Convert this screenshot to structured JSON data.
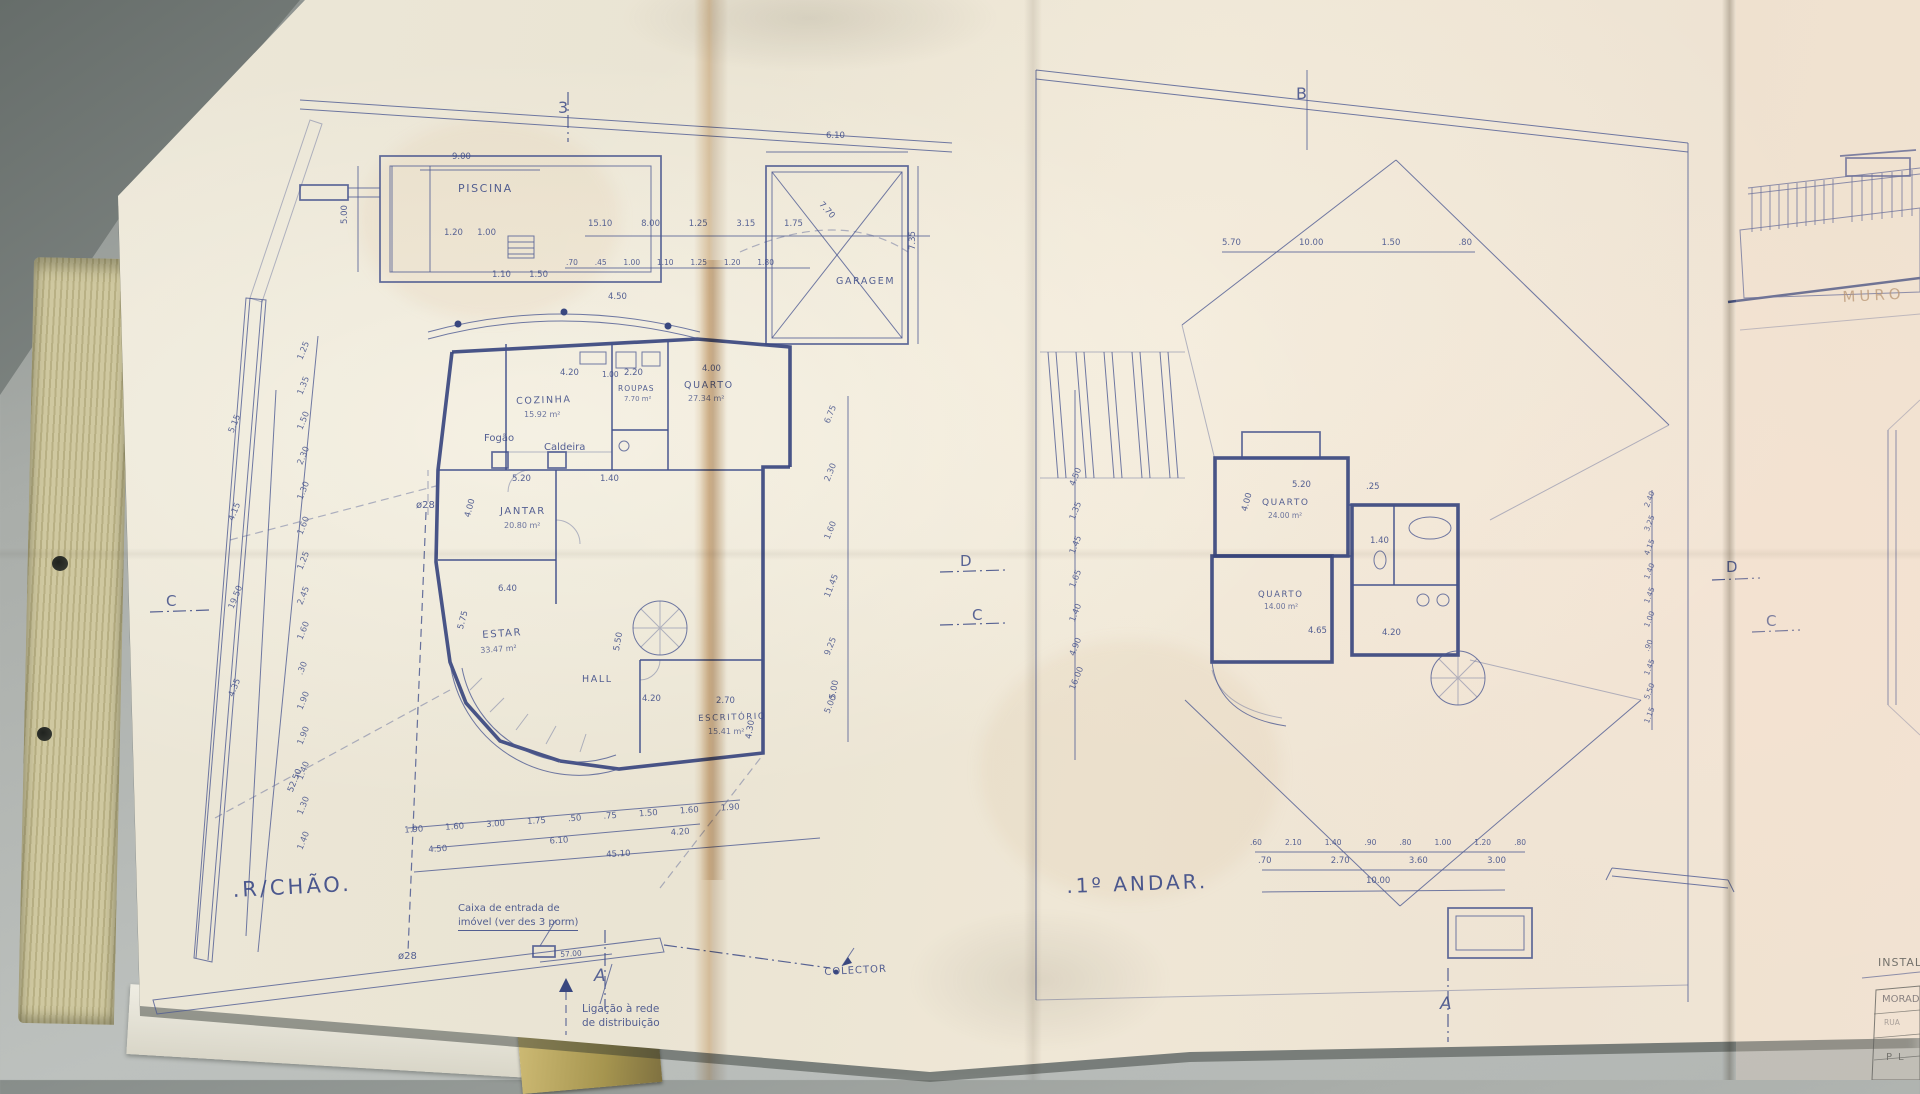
{
  "colors": {
    "ink": "#44538b",
    "ink_dark": "#39477f",
    "paper": "#ece6d6",
    "crease_tan": "#c89a5e",
    "desk": "#a9ada9",
    "binder_edge": "#c8c197",
    "muro_faded": "#a8835f"
  },
  "left_plan": {
    "title": ".R/CHÃO.",
    "markers": {
      "top": "3",
      "left": "C",
      "mid_d": "D",
      "mid_c": "C",
      "bottom": "A"
    },
    "pool": {
      "label": "PISCINA",
      "dim_w": "9.00",
      "dim_h": "5.00",
      "dims_below": [
        "1.20",
        "1.00"
      ],
      "dims_below2": [
        "1.10",
        "1.50"
      ]
    },
    "garage": {
      "label": "GARAGEM",
      "dim_w": "6.10",
      "dim_h": "7.35",
      "dim_diag": "7.70"
    },
    "rooms": {
      "cozinha": {
        "name": "COZINHA",
        "area": "15.92 m²"
      },
      "quarto": {
        "name": "QUARTO",
        "area": "27.34 m²"
      },
      "roupas": {
        "name": "ROUPAS",
        "area": "7.70 m²"
      },
      "jantar": {
        "name": "JANTAR",
        "area": "20.80 m²"
      },
      "estar": {
        "name": "ESTAR",
        "area": "33.47 m²"
      },
      "hall": {
        "name": "HALL"
      },
      "escritorio": {
        "name": "ESCRITÓRIO",
        "area": "15.41 m²"
      }
    },
    "equipment": {
      "fogao": "Fogão",
      "caldeira": "Caldeira"
    },
    "pipes": {
      "upper": "ø28",
      "lower": "ø28"
    },
    "notes": {
      "entry_line1": "Caixa de entrada de",
      "entry_line2": "imóvel (ver des 3 porm)",
      "dist_line1": "Ligação à rede",
      "dist_line2": "de distribuição",
      "collector": "COLECTOR"
    },
    "dims": {
      "top_row1": [
        "15.10",
        "8.00",
        "1.25",
        "3.15",
        "1.75"
      ],
      "top_row2": [
        ".70",
        ".45",
        "1.00",
        "1.10",
        "1.25",
        "1.20",
        "1.80"
      ],
      "left_outer": [
        "1.25",
        "1.35",
        "1.50",
        "2.30",
        "1.30",
        "1.60",
        "1.25",
        "2.45",
        "1.60",
        ".30",
        "1.90",
        "1.90",
        "1.40",
        "1.30",
        "1.40"
      ],
      "left_inner": [
        "5.15",
        "4.15",
        "19.50",
        "4.35"
      ],
      "left_total": "52.50",
      "bottom_row1": [
        "1.90",
        "1.60",
        "3.00",
        "1.75",
        ".50",
        ".75",
        "1.50",
        "1.60",
        "1.90"
      ],
      "bottom_row2": [
        "4.50",
        "6.10",
        "4.20"
      ],
      "bottom_total": "45.10",
      "right_chain": [
        "6.75",
        "2.30",
        "1.60",
        "11.45",
        "9.25",
        "5.00"
      ],
      "pipe_run": "57.00",
      "d1": "4.20",
      "d2": "1.00",
      "d3": "2.20",
      "d4": "4.00",
      "d5": "5.20",
      "d6": "1.40",
      "d7": "6.40",
      "d8": "4.00",
      "d9": "5.75",
      "d10": "5.50",
      "d11": "4.20",
      "d12": "2.70",
      "d13": "4.30",
      "d14": "5.00",
      "d15": "4.50"
    }
  },
  "right_plan": {
    "title": ".1º ANDAR.",
    "markers": {
      "top": "B",
      "bottom": "A",
      "right_d": "D",
      "right_c": "C"
    },
    "rooms": {
      "quarto1": {
        "name": "QUARTO",
        "area": "24.00 m²"
      },
      "quarto2": {
        "name": "QUARTO",
        "area": "14.00 m²"
      }
    },
    "dims": {
      "top_row": [
        "5.70",
        "10.00",
        "1.50",
        ".80"
      ],
      "bottom_row1": [
        ".60",
        "2.10",
        "1.40",
        ".90",
        ".80",
        "1.00",
        "1.20",
        ".80"
      ],
      "bottom_row2": [
        ".70",
        "2.70",
        "3.60",
        "3.00"
      ],
      "bottom_total": "10.00",
      "left_chain": [
        "4.50",
        "1.35",
        "1.45",
        "1.65",
        "1.40",
        "4.90",
        "16.00"
      ],
      "right_chain": [
        "2.40",
        "3.25",
        "4.15",
        "1.40",
        "1.45",
        "1.00",
        ".90",
        "1.45",
        "5.50",
        "1.15"
      ],
      "d1": "5.20",
      "d2": ".25",
      "d3": "4.00",
      "d4": "1.40",
      "d5": "4.65",
      "d6": "4.20"
    }
  },
  "side_sheet": {
    "muro_label": "MURO",
    "title_block": {
      "row1": "INSTAL",
      "row2": "MORAD",
      "row3": "RUA",
      "row4": "PL"
    }
  }
}
